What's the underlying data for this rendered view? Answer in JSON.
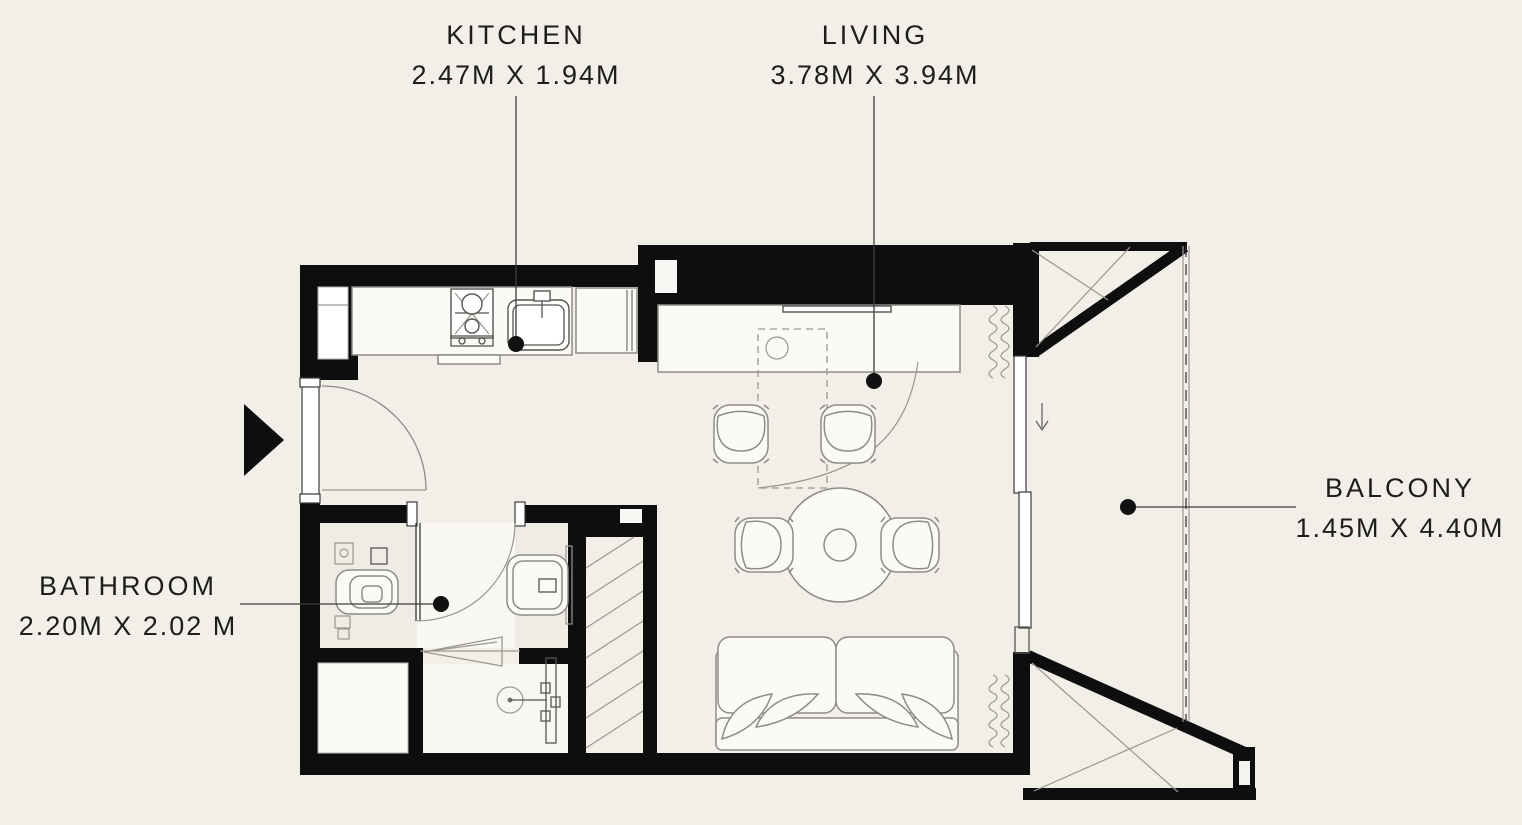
{
  "app": {
    "type": "apartment-floor-plan",
    "background": "#f2efe9",
    "wall_color": "#0e0e0e",
    "furniture_line_color": "#8e8c86"
  },
  "labels": {
    "kitchen": {
      "name": "KITCHEN",
      "size": "2.47M X 1.94M"
    },
    "living": {
      "name": "LIVING",
      "size": "3.78M X 3.94M"
    },
    "bathroom": {
      "name": "BATHROOM",
      "size": "2.20M X 2.02 M"
    },
    "balcony": {
      "name": "BALCONY",
      "size": "1.45M X 4.40M"
    }
  },
  "icons": {
    "entry": "entry-arrow-icon",
    "kitchen": [
      "stove-icon",
      "kitchen-sink-icon",
      "fridge-icon"
    ],
    "living": [
      "tv-shelf-icon",
      "dining-table-icon",
      "chair-icon",
      "sofa-icon",
      "curtain-icon"
    ],
    "bathroom": [
      "toilet-icon",
      "vanity-sink-icon",
      "shower-head-icon",
      "shower-door-icon",
      "shaft-hatch"
    ],
    "balcony": [
      "sliding-door-icon",
      "railing-icon",
      "down-arrow-icon"
    ]
  }
}
